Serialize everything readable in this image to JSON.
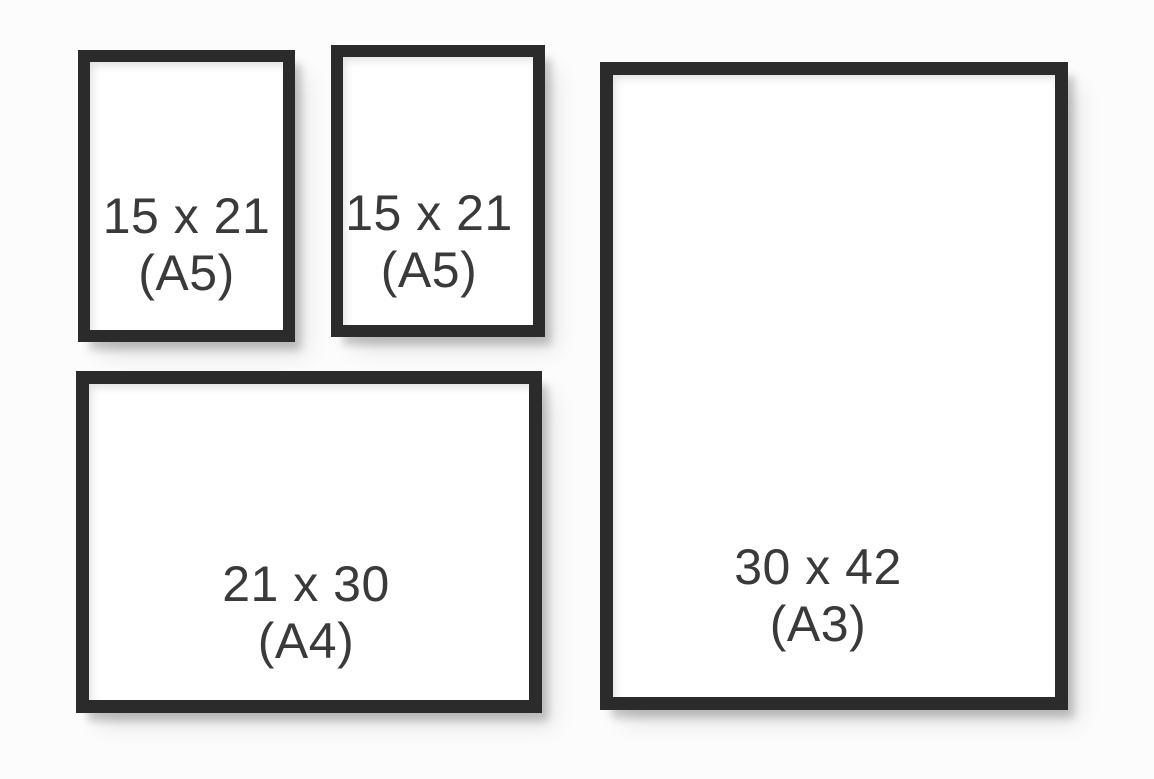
{
  "colors": {
    "wall_background": "#fcfcfc",
    "frame_border": "#2b2b2b",
    "paper": "#ffffff",
    "label_text": "#3a3a3a"
  },
  "frames": [
    {
      "dimensions": "15 x 21",
      "format": "(A5)"
    },
    {
      "dimensions": "15 x 21",
      "format": "(A5)"
    },
    {
      "dimensions": "30 x 42",
      "format": "(A3)"
    },
    {
      "dimensions": "21 x 30",
      "format": "(A4)"
    }
  ]
}
